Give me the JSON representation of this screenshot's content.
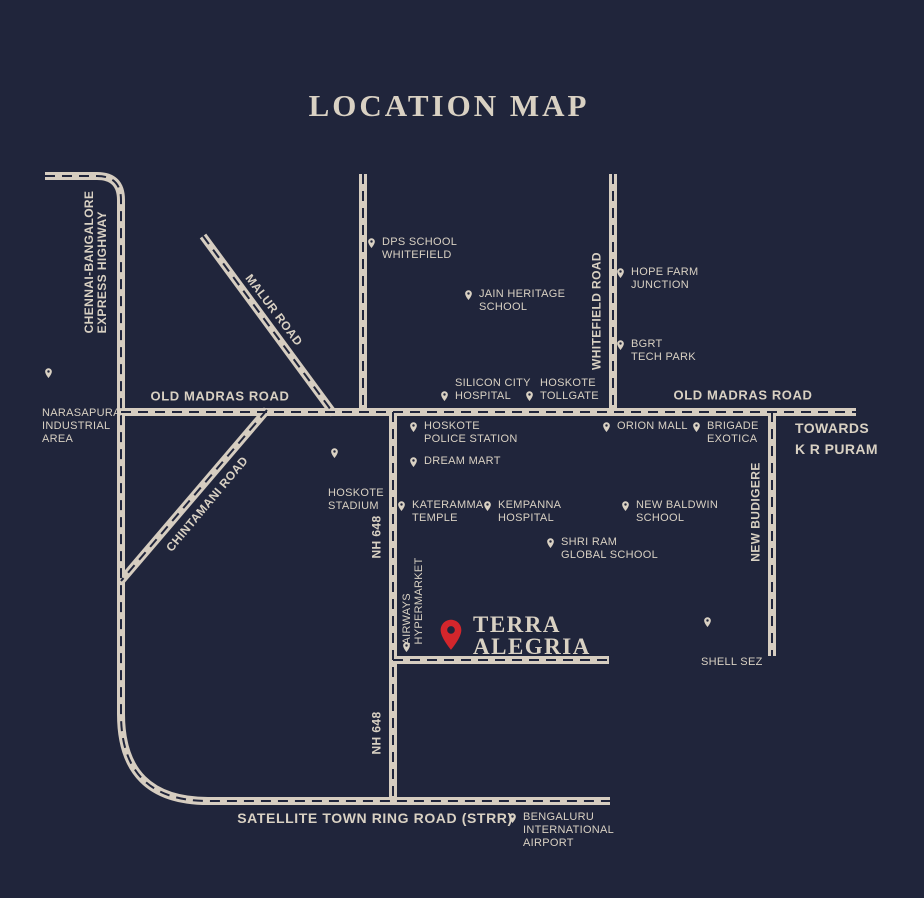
{
  "title": "LOCATION MAP",
  "colors": {
    "background": "#20253b",
    "road": "#d6cdc0",
    "text": "#d9d1c3",
    "accent_red": "#d3262c"
  },
  "roads": {
    "chennai_bangalore": "CHENNAI-BANGALORE\nEXPRESS HIGHWAY",
    "malur": "MALUR ROAD",
    "old_madras_west": "OLD MADRAS ROAD",
    "old_madras_east": "OLD MADRAS ROAD",
    "chintamani": "CHINTAMANI ROAD",
    "whitefield": "WHITEFIELD ROAD",
    "nh648_upper": "NH 648",
    "nh648_lower": "NH 648",
    "new_budigere": "NEW BUDIGERE",
    "strr": "SATELLITE TOWN RING ROAD (STRR)",
    "towards_kr_puram": "TOWARDS\nK R PURAM"
  },
  "pois": {
    "narasapura": "NARASAPURA\nINDUSTRIAL\nAREA",
    "dps_school": "DPS SCHOOL\nWHITEFIELD",
    "jain_heritage": "JAIN HERITAGE\nSCHOOL",
    "hope_farm": "HOPE FARM\nJUNCTION",
    "bgrt": "BGRT\nTECH PARK",
    "silicon_city": "SILICON CITY\nHOSPITAL",
    "hoskote_tollgate": "HOSKOTE\nTOLLGATE",
    "orion_mall": "ORION MALL",
    "brigade_exotica": "BRIGADE\nEXOTICA",
    "hoskote_stadium": "HOSKOTE\nSTADIUM",
    "hoskote_police": "HOSKOTE\nPOLICE STATION",
    "dream_mart": "DREAM MART",
    "kateramma": "KATERAMMA\nTEMPLE",
    "kempanna": "KEMPANNA\nHOSPITAL",
    "new_baldwin": "NEW BALDWIN\nSCHOOL",
    "shri_ram": "SHRI RAM\nGLOBAL SCHOOL",
    "shell_sez": "SHELL SEZ",
    "airways": "AIRWAYS\nHYPERMARKET",
    "bengaluru_airport": "BENGALURU\nINTERNATIONAL\nAIRPORT"
  },
  "project": {
    "name": "TERRA\nALEGRIA"
  }
}
